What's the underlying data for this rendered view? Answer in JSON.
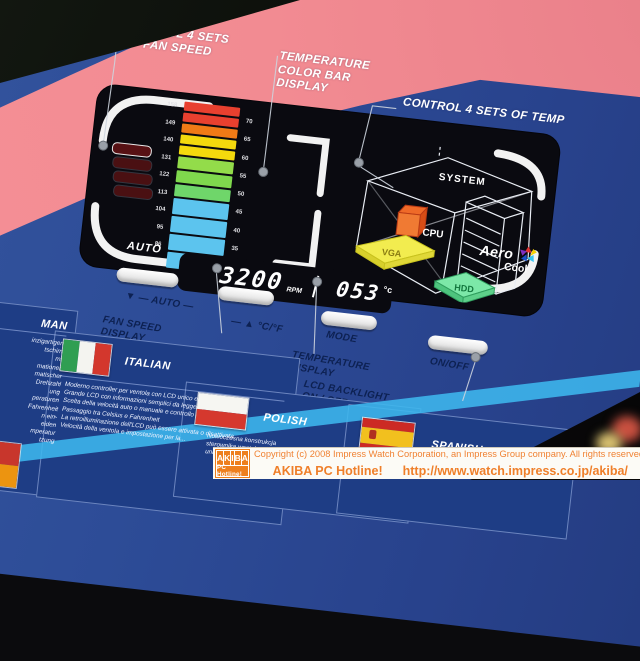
{
  "callouts": {
    "control_fan_line1": "CONTROL 4 SETS",
    "control_fan_line2": "OF FAN SPEED",
    "temp_bar_line1": "TEMPERATURE",
    "temp_bar_line2": "COLOR BAR",
    "temp_bar_line3": "DISPLAY",
    "control_temp": "CONTROL 4 SETS OF TEMP"
  },
  "lcd": {
    "auto_label": "AUTO",
    "rpm_value": "3200",
    "rpm_unit": "RPM",
    "temp_value": "053",
    "temp_unit": "°c",
    "f_ticks": [
      "158",
      "149",
      "140",
      "131",
      "122",
      "113",
      "104",
      "95",
      "86"
    ],
    "c_ticks": [
      "70",
      "65",
      "60",
      "55",
      "50",
      "45",
      "40",
      "35",
      "30"
    ],
    "bar_colors": [
      "#e8402f",
      "#e8402f",
      "#f07a16",
      "#f4d90d",
      "#f4d90d",
      "#93dc4a",
      "#7fd84d",
      "#6fd66a",
      "#5cc4ee",
      "#5cc4ee",
      "#5cc4ee",
      "#5cc4ee"
    ],
    "diagram": {
      "system": "SYSTEM",
      "cpu": "CPU",
      "vga": "VGA",
      "hdd": "HDD"
    },
    "logo": {
      "aero": "Aero",
      "cool": "Cool"
    }
  },
  "controls": {
    "auto_row": "▼ ― AUTO ―",
    "cf_row": "― ▲ °C/°F",
    "fan_speed_display_l1": "FAN SPEED",
    "fan_speed_display_l2": "DISPLAY",
    "mode": "MODE",
    "on_off": "ON/OFF",
    "temperature_display_l1": "TEMPERATURE",
    "temperature_display_l2": "DISPLAY",
    "lcd_backlight_l1": "LCD BACKLIGHT",
    "lcd_backlight_l2": "ON / OFF"
  },
  "languages": {
    "german": {
      "title_visible": "MAN",
      "fragments": [
        "inzigartigem",
        "tschirm",
        "mit",
        "mationen",
        "matischer",
        "Drehzahl",
        "ung",
        "peraturen",
        "Fahrenheit",
        "n ein-",
        "eiden",
        "mperatur",
        "tzung"
      ]
    },
    "italian": {
      "title": "ITALIAN",
      "bullets": [
        "Moderno controller per ventola con LCD unico e colorato",
        "Grande LCD con informazioni semplici da leggere",
        "Scelta della velocità auto o manuale e controllo della temperatura",
        "Passaggio tra Celsius e Fahrenheit",
        "La retroilluminazione dell'LCD può essere attivata o disattivata",
        "Velocità della ventola e impostazione per la..."
      ]
    },
    "polish": {
      "title": "POLISH",
      "lines": [
        "Nowoczesna konstrukcja",
        "sterownika wentylatora",
        "unikalnym..."
      ]
    },
    "spanish": {
      "title": "SPANISH"
    }
  },
  "footer": {
    "logo_letters": [
      "A",
      "K",
      "I",
      "B",
      "A"
    ],
    "logo_sub": "PC Hotline!",
    "copyright": "Copyright (c) 2008 Impress Watch Corporation, an Impress Group company. All rights reserved.",
    "site_name": "AKIBA PC Hotline!",
    "url": "http://www.watch.impress.co.jp/akiba/"
  },
  "colors": {
    "box_blue": "#2d4c97",
    "swoosh_pink": "#f28b92",
    "stripe_cyan": "#3db7ee",
    "accent_orange": "#ee7f1d",
    "label_navy": "#0d2152"
  }
}
